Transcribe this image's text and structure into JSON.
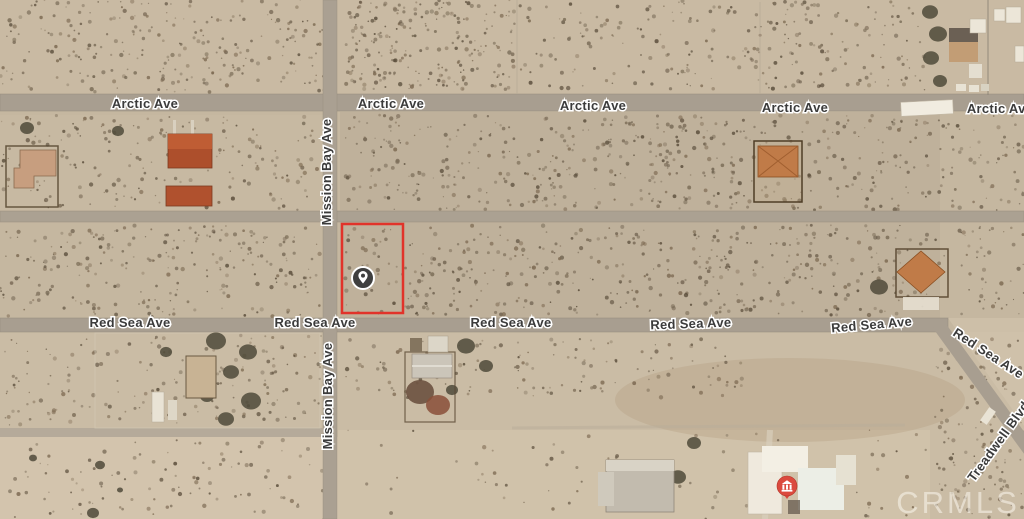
{
  "map": {
    "type": "satellite-aerial-view",
    "provider_watermark": "CRMLS",
    "colors": {
      "terrain_base": "#c5b7a0",
      "road": "#a89e90",
      "label_text": "#3b3b3b",
      "label_halo": "#ffffff",
      "parcel_highlight": "#e1332a",
      "subject_pin_fill": "#3f3f3f",
      "subject_pin_glyph": "#ffffff",
      "poi_marker_fill": "#db4a3e",
      "poi_marker_glyph": "#ffffff"
    },
    "street_labels": [
      {
        "name": "Arctic Ave",
        "x": 145,
        "y": 108,
        "rotate": 0
      },
      {
        "name": "Arctic Ave",
        "x": 391,
        "y": 108,
        "rotate": 0
      },
      {
        "name": "Arctic Ave",
        "x": 593,
        "y": 110,
        "rotate": 0
      },
      {
        "name": "Arctic Ave",
        "x": 795,
        "y": 112,
        "rotate": 0
      },
      {
        "name": "Arctic Ave",
        "x": 1000,
        "y": 113,
        "rotate": 0
      },
      {
        "name": "Mission Bay Ave",
        "x": 331,
        "y": 172,
        "rotate": -90
      },
      {
        "name": "Mission Bay Ave",
        "x": 332,
        "y": 396,
        "rotate": -90
      },
      {
        "name": "Red Sea Ave",
        "x": 130,
        "y": 327,
        "rotate": 0
      },
      {
        "name": "Red Sea Ave",
        "x": 315,
        "y": 327,
        "rotate": 0
      },
      {
        "name": "Red Sea Ave",
        "x": 511,
        "y": 327,
        "rotate": 0
      },
      {
        "name": "Red Sea Ave",
        "x": 691,
        "y": 328,
        "rotate": -2
      },
      {
        "name": "Red Sea Ave",
        "x": 872,
        "y": 329,
        "rotate": -5
      },
      {
        "name": "Red Sea Ave",
        "x": 986,
        "y": 357,
        "rotate": 33
      },
      {
        "name": "Treadwell Blvd",
        "x": 1002,
        "y": 444,
        "rotate": -54
      }
    ],
    "parcel_highlight": {
      "x": 342,
      "y": 224,
      "width": 61,
      "height": 89
    },
    "markers": {
      "subject_pin": {
        "kind": "location-pin",
        "x": 363,
        "y": 278
      },
      "poi": {
        "kind": "building-poi",
        "x": 787,
        "y": 486
      }
    }
  }
}
